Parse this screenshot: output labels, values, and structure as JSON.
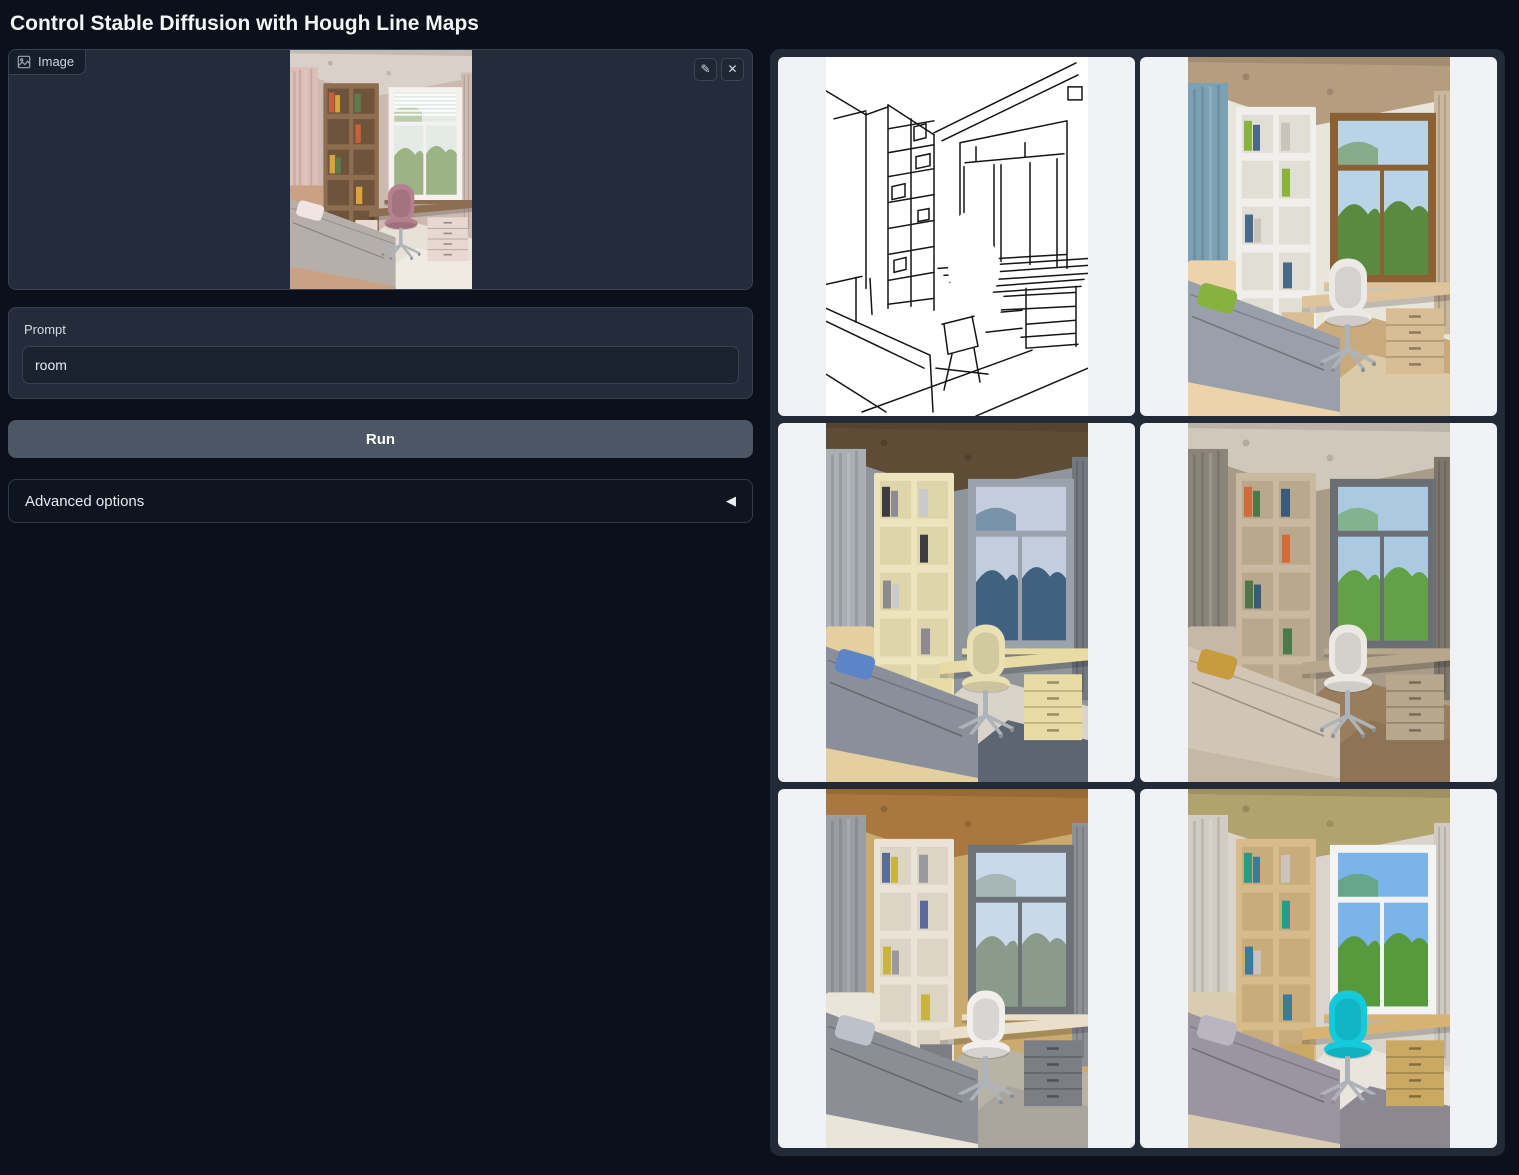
{
  "page": {
    "title": "Control Stable Diffusion with Hough Line Maps"
  },
  "input_panel": {
    "image_label": "Image",
    "prompt_label": "Prompt",
    "prompt_value": "room",
    "run_label": "Run",
    "advanced_label": "Advanced options"
  },
  "icons": {
    "edit": "✎",
    "clear": "✕",
    "accordion_arrow": "◀",
    "image_badge": "picture-icon"
  },
  "colors": {
    "page_bg": "#0c101a",
    "block_bg": "#242c3b",
    "border": "#374151",
    "run_button_bg": "#4c5664",
    "gallery_bg": "#222a38",
    "tile_bg": "#f0f2f5",
    "text": "#e8eaee"
  },
  "input_image": {
    "description": "Uploaded photo: child's bedroom with floral wallpaper, wood bookshelf, window with blinds, desk, pink chair, gray bed",
    "palette": {
      "ceiling": "#d9d0ca",
      "wall": "#cdb9b0",
      "curtain": "#ddbfb8",
      "curtain2": "#d0bbb2",
      "shelf": "#8d6e50",
      "shelfCell": "#6f543c",
      "frame": "#f4f2ef",
      "sky": "#e4ebe6",
      "view": "#9cb483",
      "desk": "#8d6e50",
      "drawer": "#e9d8d2",
      "chair": "#b5808f",
      "bed": "#b6afa9",
      "bedFrame": "#c9a285",
      "pillow": "#f1e5e3",
      "floor": "#e7e1d7",
      "rug": "#efebe3",
      "book0": "#c65f3a",
      "book1": "#d8a43e",
      "book2": "#5d7c4c",
      "blindsO": "1"
    }
  },
  "gallery": {
    "items": [
      {
        "id": "hough-line-map",
        "type": "lines",
        "description": "Hough line map: black line sketch of the room on white"
      },
      {
        "id": "generated-room-1",
        "type": "photo",
        "description": "Generated bedroom: wood ceiling, blue curtains, white shelf, wood window with trees, green pillow",
        "palette": {
          "ceiling": "#b59d80",
          "wall": "#e9e5db",
          "curtain": "#7ba2b4",
          "curtain2": "#c9b79e",
          "shelf": "#f1efeb",
          "shelfCell": "#e1ded6",
          "frame": "#8a6134",
          "sky": "#bad4e7",
          "view": "#598a40",
          "desk": "#dfc39b",
          "drawer": "#d9bd94",
          "chair": "#eceae6",
          "bed": "#9aa0aa",
          "bedFrame": "#ecd3a9",
          "pillow": "#86b23f",
          "floor": "#c9aa7c",
          "rug": "#dbcaa8",
          "book0": "#8ab33c",
          "book1": "#49698a",
          "book2": "#c9c3b9"
        }
      },
      {
        "id": "generated-room-2",
        "type": "photo",
        "description": "Generated bedroom: dark wood ceiling, gray curtains, cream shelf and chair, dusk sea view, blue pillow",
        "palette": {
          "ceiling": "#5e4c36",
          "wall": "#90949b",
          "curtain": "#aaaeb5",
          "curtain2": "#73777f",
          "shelf": "#ece4bd",
          "shelfCell": "#ded5aa",
          "frame": "#9aa2ab",
          "sky": "#c2cedd",
          "view": "#40617f",
          "desk": "#e9dba5",
          "drawer": "#e9dba5",
          "chair": "#e9e0b3",
          "bed": "#8b8f99",
          "bedFrame": "#e3cf9f",
          "pillow": "#5b85c6",
          "floor": "#d9d3c9",
          "rug": "#5d6572",
          "book0": "#3c3c40",
          "book1": "#8c8c90",
          "book2": "#cacace"
        }
      },
      {
        "id": "generated-room-3",
        "type": "photo",
        "description": "Generated bedroom: taupe walls, spotlights, wood shelf, green tree view, mustard pillow, wood floor",
        "palette": {
          "ceiling": "#d0c8bb",
          "wall": "#a89b88",
          "curtain": "#8b8479",
          "curtain2": "#7d766b",
          "shelf": "#c9b9a0",
          "shelfCell": "#b9a88c",
          "frame": "#6b6f74",
          "sky": "#abcae2",
          "view": "#63a149",
          "desk": "#b7a78d",
          "drawer": "#b7a78d",
          "chair": "#ece9e4",
          "bed": "#d1c6b5",
          "bedFrame": "#c5b9a5",
          "pillow": "#c89c3e",
          "floor": "#9a7d5d",
          "rug": "#8e7354",
          "book0": "#d4693a",
          "book1": "#4a7a4a",
          "book2": "#3a5a7a"
        }
      },
      {
        "id": "generated-room-4",
        "type": "photo",
        "description": "Generated bedroom: orange wood ceiling, gray curtains, cream shelf, landscape view, gray patterned bed",
        "palette": {
          "ceiling": "#aa773f",
          "wall": "#caaa6d",
          "curtain": "#9b9da2",
          "curtain2": "#8e9096",
          "shelf": "#eae4d7",
          "shelfCell": "#dcd5c5",
          "frame": "#6d7379",
          "sky": "#cad9e9",
          "view": "#8b9b8b",
          "desk": "#eadfcb",
          "drawer": "#7b7e84",
          "chair": "#f1efeb",
          "bed": "#8b8e95",
          "bedFrame": "#eae5d9",
          "pillow": "#bdc1c9",
          "floor": "#b9b3a6",
          "rug": "#a9a59c",
          "book0": "#5a6a9a",
          "book1": "#c9b43d",
          "book2": "#9a9a9e"
        }
      },
      {
        "id": "generated-room-5",
        "type": "photo",
        "description": "Generated bedroom: textured tan ceiling, light walls, wood shelf and desk, white window with blue sky, bright cyan chair",
        "palette": {
          "ceiling": "#b2a26d",
          "wall": "#dad4cc",
          "curtain": "#d2ccc4",
          "curtain2": "#cfc9c1",
          "shelf": "#d7bb8b",
          "shelfCell": "#c8ac7b",
          "frame": "#f3f3f3",
          "sky": "#7ab4e8",
          "view": "#579a3e",
          "desk": "#d7b373",
          "drawer": "#caa965",
          "chair": "#15cada",
          "bed": "#9b95a1",
          "bedFrame": "#daccb1",
          "pillow": "#bab6c0",
          "floor": "#e9e5dd",
          "rug": "#8b8892",
          "book0": "#2a9a8a",
          "book1": "#3a7a9a",
          "book2": "#c9c3b9"
        }
      }
    ]
  }
}
